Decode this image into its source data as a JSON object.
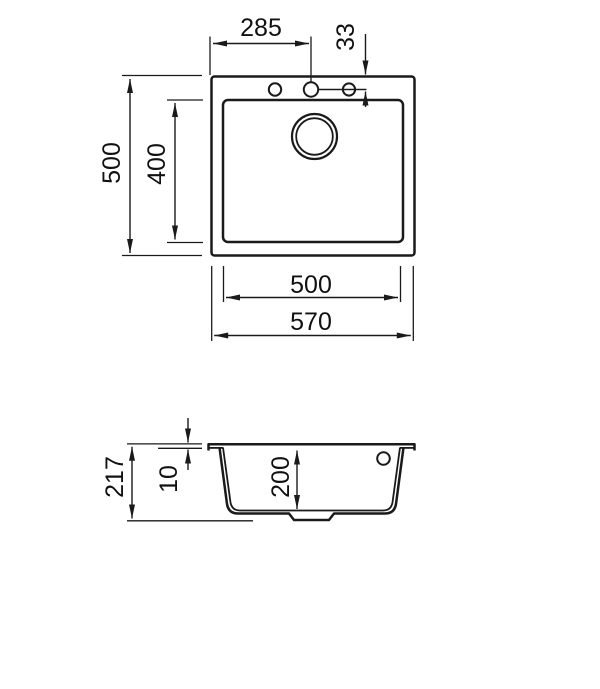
{
  "drawing": {
    "title": "sink-technical-drawing",
    "colors": {
      "line": "#1a1a1a",
      "background": "#ffffff"
    },
    "plan_view": {
      "dims": {
        "faucet_center_x": "285",
        "faucet_offset_y": "33",
        "outer_depth": "500",
        "bowl_depth_plan": "400",
        "bowl_width": "500",
        "outer_width": "570"
      }
    },
    "section_view": {
      "dims": {
        "total_height": "217",
        "rim_thickness": "10",
        "bowl_depth": "200"
      }
    }
  }
}
